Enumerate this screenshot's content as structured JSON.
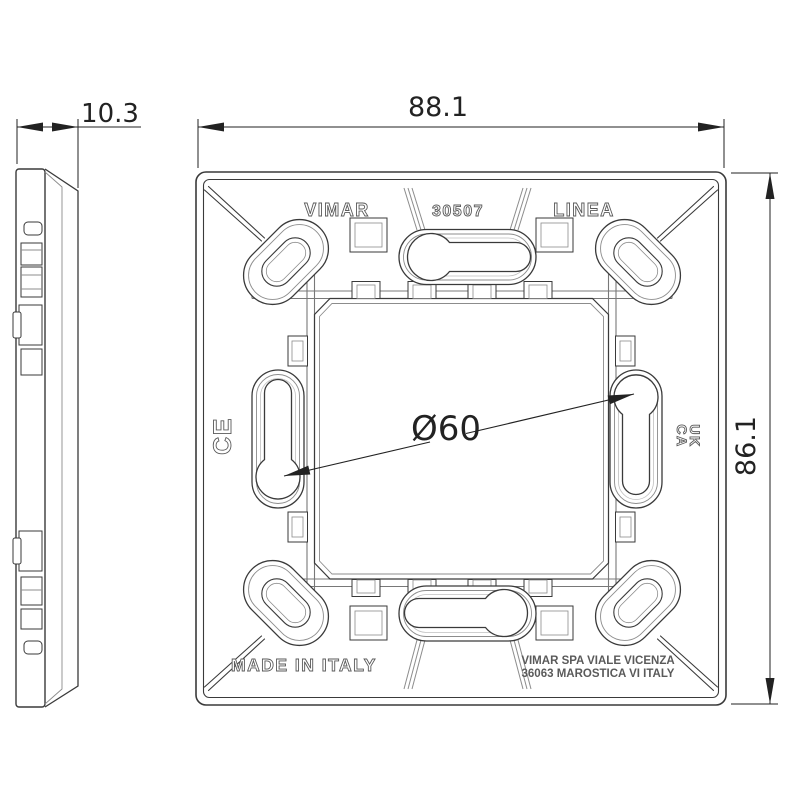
{
  "dimensions": {
    "depth": "10.3",
    "width": "88.1",
    "height": "86.1",
    "hole_circle": "Ø60"
  },
  "markings": {
    "brand": "VIMAR",
    "model": "30507",
    "series": "LINEA",
    "ce": "CE",
    "ukca_top": "UK",
    "ukca_bottom": "CA",
    "made_in": "MADE IN ITALY",
    "manufacturer_line1": "VIMAR SPA VIALE VICENZA",
    "manufacturer_line2": "36063 MAROSTICA VI ITALY"
  },
  "colors": {
    "line": "#3a3a3a",
    "line_light": "#8c8c8c",
    "rail": "#787878",
    "text_outline": "#5a5a5a",
    "dim_text": "#222222",
    "background": "#ffffff"
  }
}
